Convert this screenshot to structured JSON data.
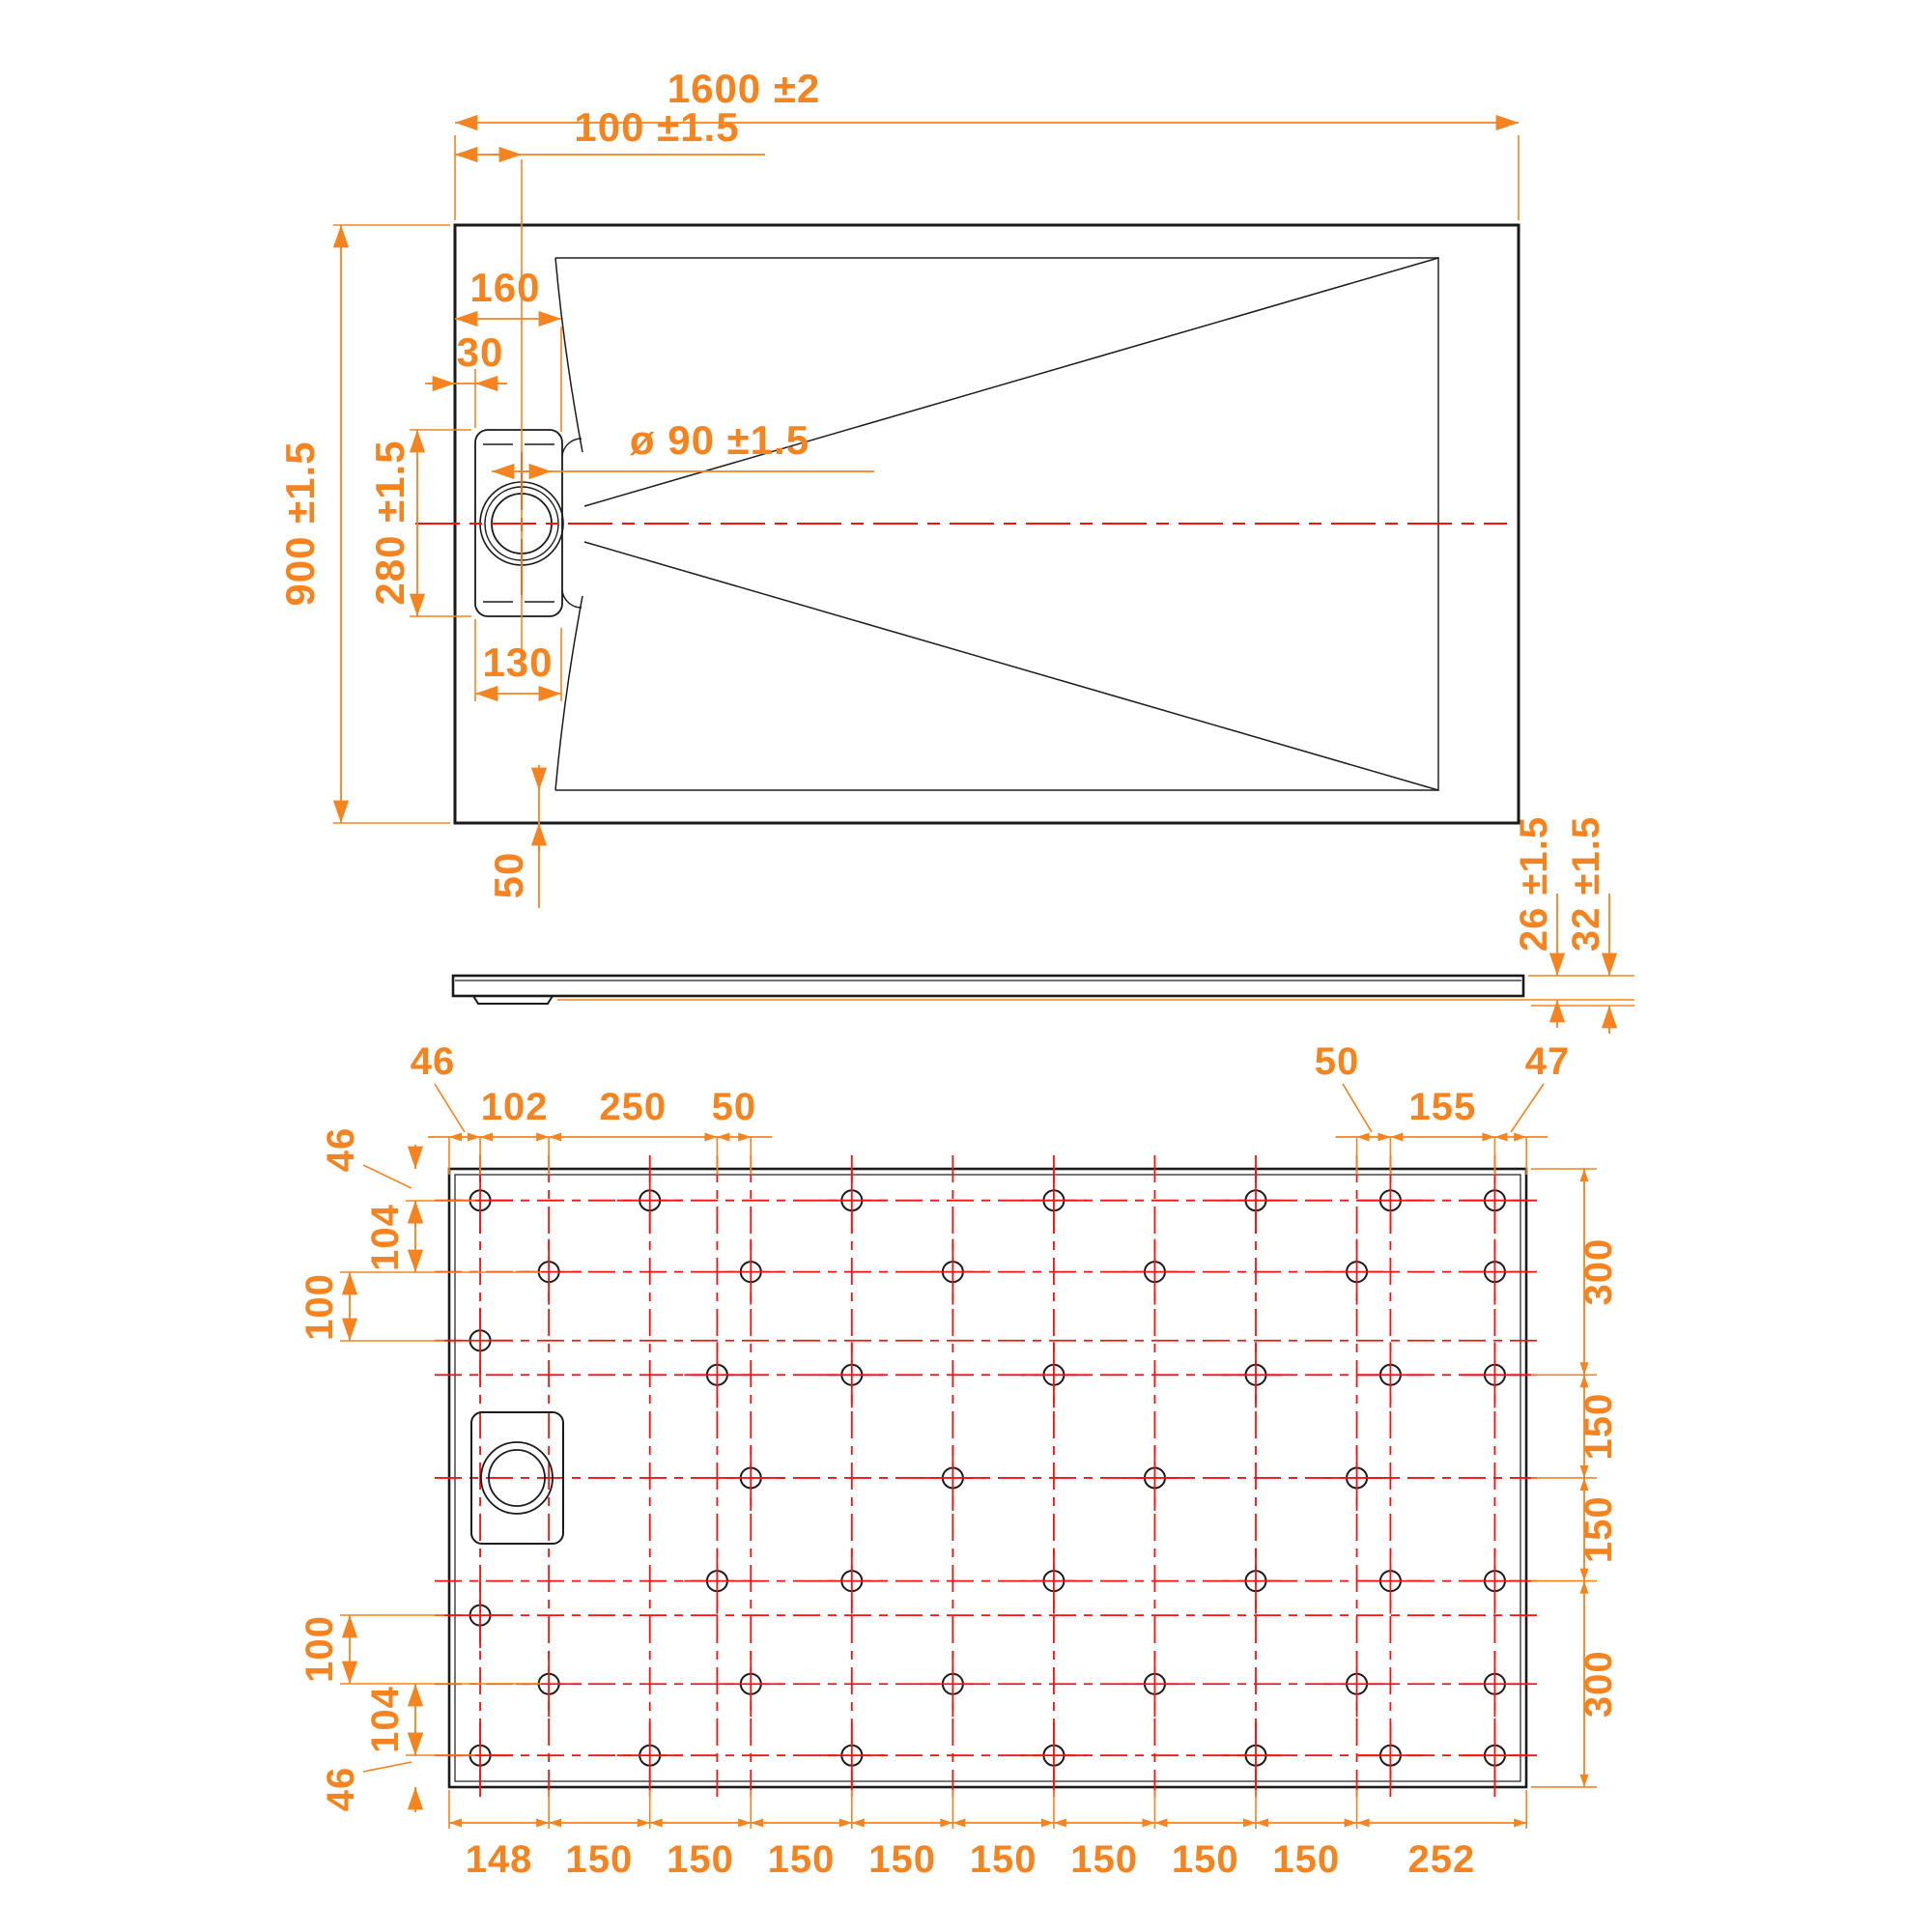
{
  "drawing": {
    "type": "technical-dimension-drawing",
    "subject": "Rectangular shower tray 1600x900 with offset round drain - top view, side profile and bottom hole-pattern view",
    "colors": {
      "dimension": "#F5831F",
      "centerline": "#F81111",
      "outline": "#1A1A1A"
    }
  },
  "top_view": {
    "overall_width": "1600 ±2",
    "drain_offset": "100 ±1.5",
    "edge_to_floor": "160",
    "edge_to_cassette": "30",
    "overall_depth": "900 ±1.5",
    "cassette_length": "280 ±1.5",
    "drain_diameter": "ø 90 ±1.5",
    "cassette_width": "130",
    "rim_border": "50"
  },
  "side_view": {
    "body_thickness": "26 ±1.5",
    "total_thickness": "32 ±1.5"
  },
  "bottom_view": {
    "top_left_leader": "46",
    "top_dims": {
      "d102": "102",
      "d250": "250",
      "d50": "50"
    },
    "top_right": {
      "d50": "50",
      "d155": "155",
      "d47": "47"
    },
    "left_dims_top": {
      "d46": "46",
      "d104": "104",
      "d100": "100"
    },
    "left_dims_bottom": {
      "d100": "100",
      "d104": "104",
      "d46": "46"
    },
    "right_dims": [
      "300",
      "150",
      "150",
      "300"
    ],
    "bottom_dims": [
      "148",
      "150",
      "150",
      "150",
      "150",
      "150",
      "150",
      "150",
      "150",
      "252"
    ],
    "grid": {
      "columns_mm": [
        46,
        148,
        298,
        398,
        448,
        598,
        748,
        898,
        1048,
        1198,
        1348,
        1398,
        1553
      ],
      "rows_mm": [
        46,
        150,
        250,
        300,
        450,
        600,
        650,
        750,
        854
      ],
      "right_chain_mm": [
        0,
        300,
        450,
        600,
        900
      ],
      "bottom_chain_mm": [
        0,
        148,
        298,
        448,
        598,
        748,
        898,
        1048,
        1198,
        1348,
        1600
      ],
      "top_left_chain_mm": [
        0,
        46,
        148,
        398,
        448
      ],
      "top_right_chain_mm": [
        1348,
        1398,
        1553,
        1600
      ],
      "holes": [
        {
          "row_mm": 46,
          "cols_mm": [
            46,
            298,
            598,
            898,
            1198,
            1398,
            1553
          ]
        },
        {
          "row_mm": 150,
          "cols_mm": [
            148,
            448,
            748,
            1048,
            1348,
            1553
          ]
        },
        {
          "row_mm": 250,
          "cols_mm": [
            46
          ]
        },
        {
          "row_mm": 300,
          "cols_mm": [
            398,
            598,
            898,
            1198,
            1398,
            1553
          ]
        },
        {
          "row_mm": 450,
          "cols_mm": [
            448,
            748,
            1048,
            1348
          ]
        },
        {
          "row_mm": 600,
          "cols_mm": [
            398,
            598,
            898,
            1198,
            1398,
            1553
          ]
        },
        {
          "row_mm": 650,
          "cols_mm": [
            46
          ]
        },
        {
          "row_mm": 750,
          "cols_mm": [
            148,
            448,
            748,
            1048,
            1348,
            1553
          ]
        },
        {
          "row_mm": 854,
          "cols_mm": [
            46,
            298,
            598,
            898,
            1198,
            1398,
            1553
          ]
        }
      ]
    }
  }
}
